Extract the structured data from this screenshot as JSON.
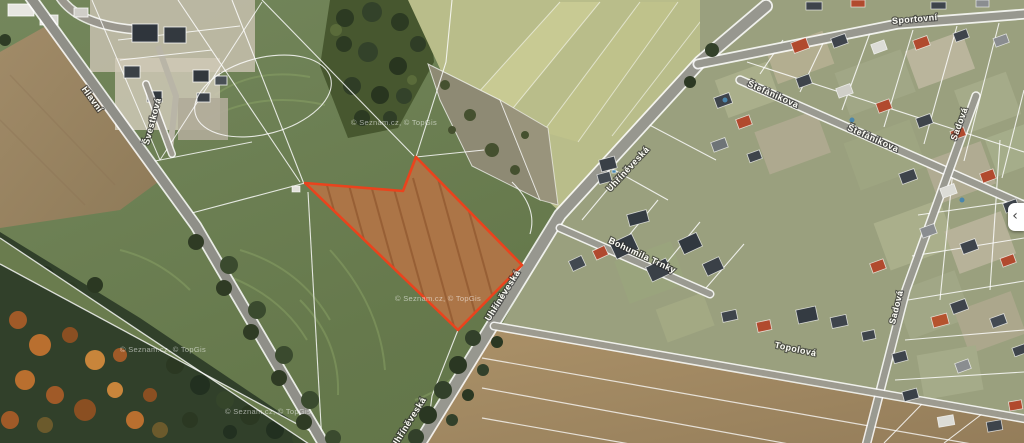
{
  "map": {
    "type": "aerial-cadastral-view",
    "street_labels": [
      {
        "name": "Hlavní",
        "x": 90,
        "y": 101,
        "angle": 54
      },
      {
        "name": "Švestková",
        "x": 155,
        "y": 122,
        "angle": -75
      },
      {
        "name": "Uhříněveská",
        "x": 630,
        "y": 171,
        "angle": -47
      },
      {
        "name": "Uhříněveská",
        "x": 505,
        "y": 297,
        "angle": -58
      },
      {
        "name": "Uhříněveská",
        "x": 411,
        "y": 424,
        "angle": -58
      },
      {
        "name": "Bohumila Trnky",
        "x": 641,
        "y": 258,
        "angle": 25
      },
      {
        "name": "Štefánikova",
        "x": 772,
        "y": 97,
        "angle": 24
      },
      {
        "name": "Štefánikova",
        "x": 872,
        "y": 141,
        "angle": 24
      },
      {
        "name": "Sportovní",
        "x": 915,
        "y": 22,
        "angle": -5
      },
      {
        "name": "Sadová",
        "x": 962,
        "y": 125,
        "angle": -70
      },
      {
        "name": "Sadová",
        "x": 899,
        "y": 308,
        "angle": -76
      },
      {
        "name": "Topolová",
        "x": 795,
        "y": 352,
        "angle": 12
      }
    ],
    "watermark": {
      "text": "© Seznam.cz, © TopGis",
      "positions": [
        [
          394,
          125
        ],
        [
          438,
          301
        ],
        [
          163,
          352
        ],
        [
          268,
          414
        ]
      ]
    },
    "selected_parcel": {
      "outline_color": "#ea431d",
      "fill_tint": "rgba(230,80,35,0.18)"
    },
    "panel_toggle": {
      "glyph": "‹"
    }
  }
}
